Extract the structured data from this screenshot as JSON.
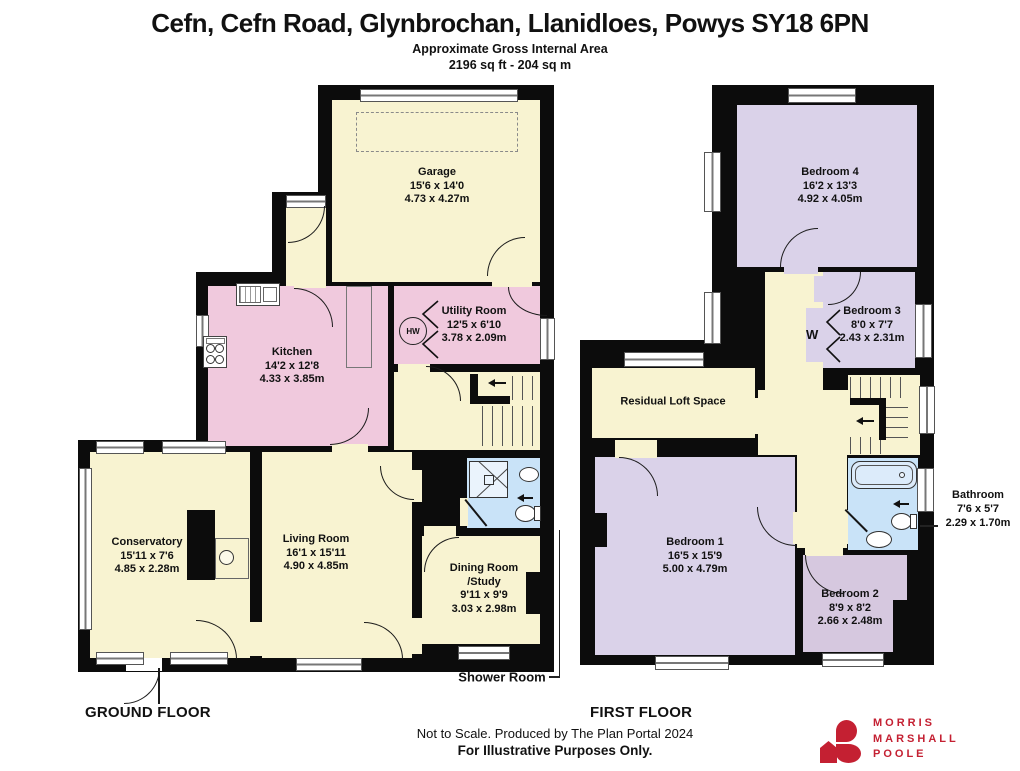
{
  "header": {
    "title": "Cefn, Cefn Road, Glynbrochan, Llanidloes, Powys SY18 6PN",
    "subtitle": "Approximate Gross Internal Area",
    "area": "2196 sq ft - 204 sq m"
  },
  "ground_floor": {
    "label": "GROUND FLOOR",
    "rooms": {
      "garage": {
        "name": "Garage",
        "imperial": "15'6 x 14'0",
        "metric": "4.73 x 4.27m"
      },
      "utility": {
        "name": "Utility Room",
        "imperial": "12'5 x 6'10",
        "metric": "3.78 x 2.09m"
      },
      "kitchen": {
        "name": "Kitchen",
        "imperial": "14'2 x 12'8",
        "metric": "4.33 x 3.85m"
      },
      "conservatory": {
        "name": "Conservatory",
        "imperial": "15'11 x 7'6",
        "metric": "4.85 x 2.28m"
      },
      "living_room": {
        "name": "Living Room",
        "imperial": "16'1 x 15'11",
        "metric": "4.90 x 4.85m"
      },
      "dining_room": {
        "name": "Dining Room",
        "name2": "/Study",
        "imperial": "9'11 x 9'9",
        "metric": "3.03 x 2.98m"
      },
      "shower_room": {
        "name": "Shower Room"
      }
    },
    "annotations": {
      "hot_water": "HW"
    }
  },
  "first_floor": {
    "label": "FIRST FLOOR",
    "rooms": {
      "bedroom4": {
        "name": "Bedroom 4",
        "imperial": "16'2 x 13'3",
        "metric": "4.92 x 4.05m"
      },
      "bedroom3": {
        "name": "Bedroom 3",
        "imperial": "8'0 x 7'7",
        "metric": "2.43 x 2.31m"
      },
      "loft": {
        "name": "Residual Loft Space"
      },
      "bedroom1": {
        "name": "Bedroom 1",
        "imperial": "16'5 x 15'9",
        "metric": "5.00 x 4.79m"
      },
      "bathroom": {
        "name": "Bathroom",
        "imperial": "7'6 x 5'7",
        "metric": "2.29 x 1.70m"
      },
      "bedroom2": {
        "name": "Bedroom 2",
        "imperial": "8'9 x 8'2",
        "metric": "2.66 x 2.48m"
      }
    },
    "annotations": {
      "wardrobe": "W"
    }
  },
  "footer": {
    "note1": "Not to Scale. Produced by The Plan Portal 2024",
    "note2": "For Illustrative Purposes Only."
  },
  "logo": {
    "line1": "MORRIS",
    "line2": "MARSHALL",
    "line3": "POOLE"
  },
  "icons": [
    "hot-water-cylinder-icon",
    "hob-icon",
    "kitchen-sink-icon",
    "stove-icon",
    "shower-tray-icon",
    "toilet-icon",
    "basin-icon",
    "bath-icon",
    "stairs-up-arrow-icon",
    "wardrobe-bifold-icon",
    "garage-door-dashed-icon",
    "mmp-logo-icon"
  ],
  "colors": {
    "room_cream": "#F8F3D1",
    "room_pink": "#F0C9DD",
    "room_lavender": "#DAD2E9",
    "room_purple": "#D6C8DF",
    "room_blue": "#C9E3F8",
    "walls": "#0C0C0C",
    "brand_red": "#C42032"
  }
}
